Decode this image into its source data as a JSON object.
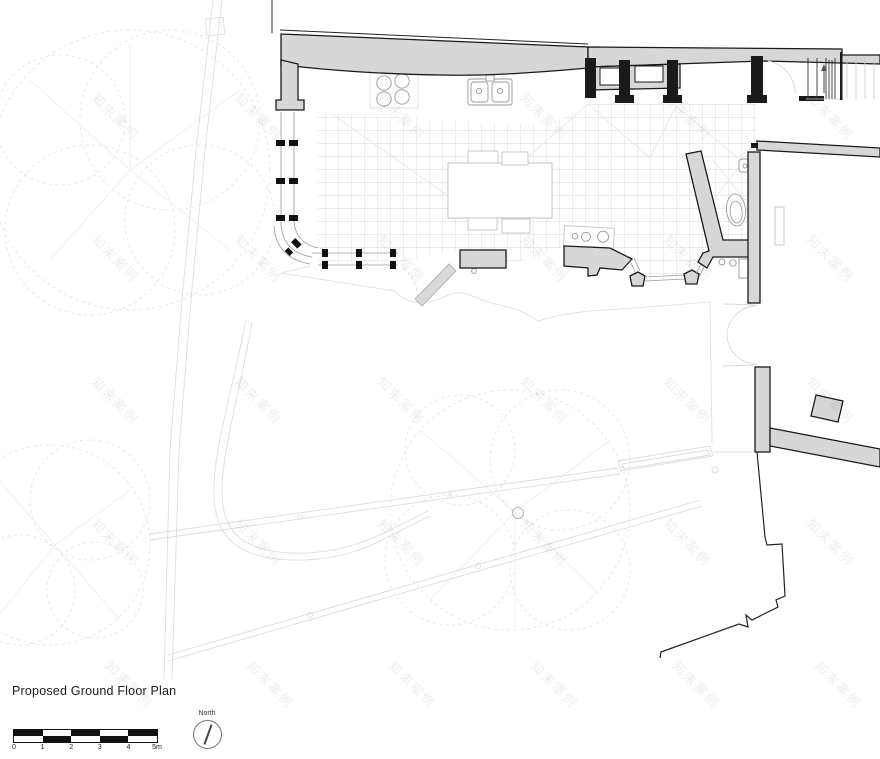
{
  "title": "Proposed Ground Floor Plan",
  "scale_bar": {
    "unit_labels": [
      "0",
      "1",
      "2",
      "3",
      "4",
      "5m"
    ]
  },
  "north_indicator": {
    "label": "North"
  },
  "watermark": {
    "text": "知末案例"
  },
  "colors": {
    "background": "#ffffff",
    "wall_fill": "#d7d7d7",
    "wall_outline": "#1a1a1a",
    "tile_grid": "#cdcdcd",
    "faint_linework": "#e3e3e3",
    "tree_linework": "#e9e9e9",
    "watermark_tint": "rgba(0,0,0,0.07)",
    "text": "#1c1c1e"
  }
}
